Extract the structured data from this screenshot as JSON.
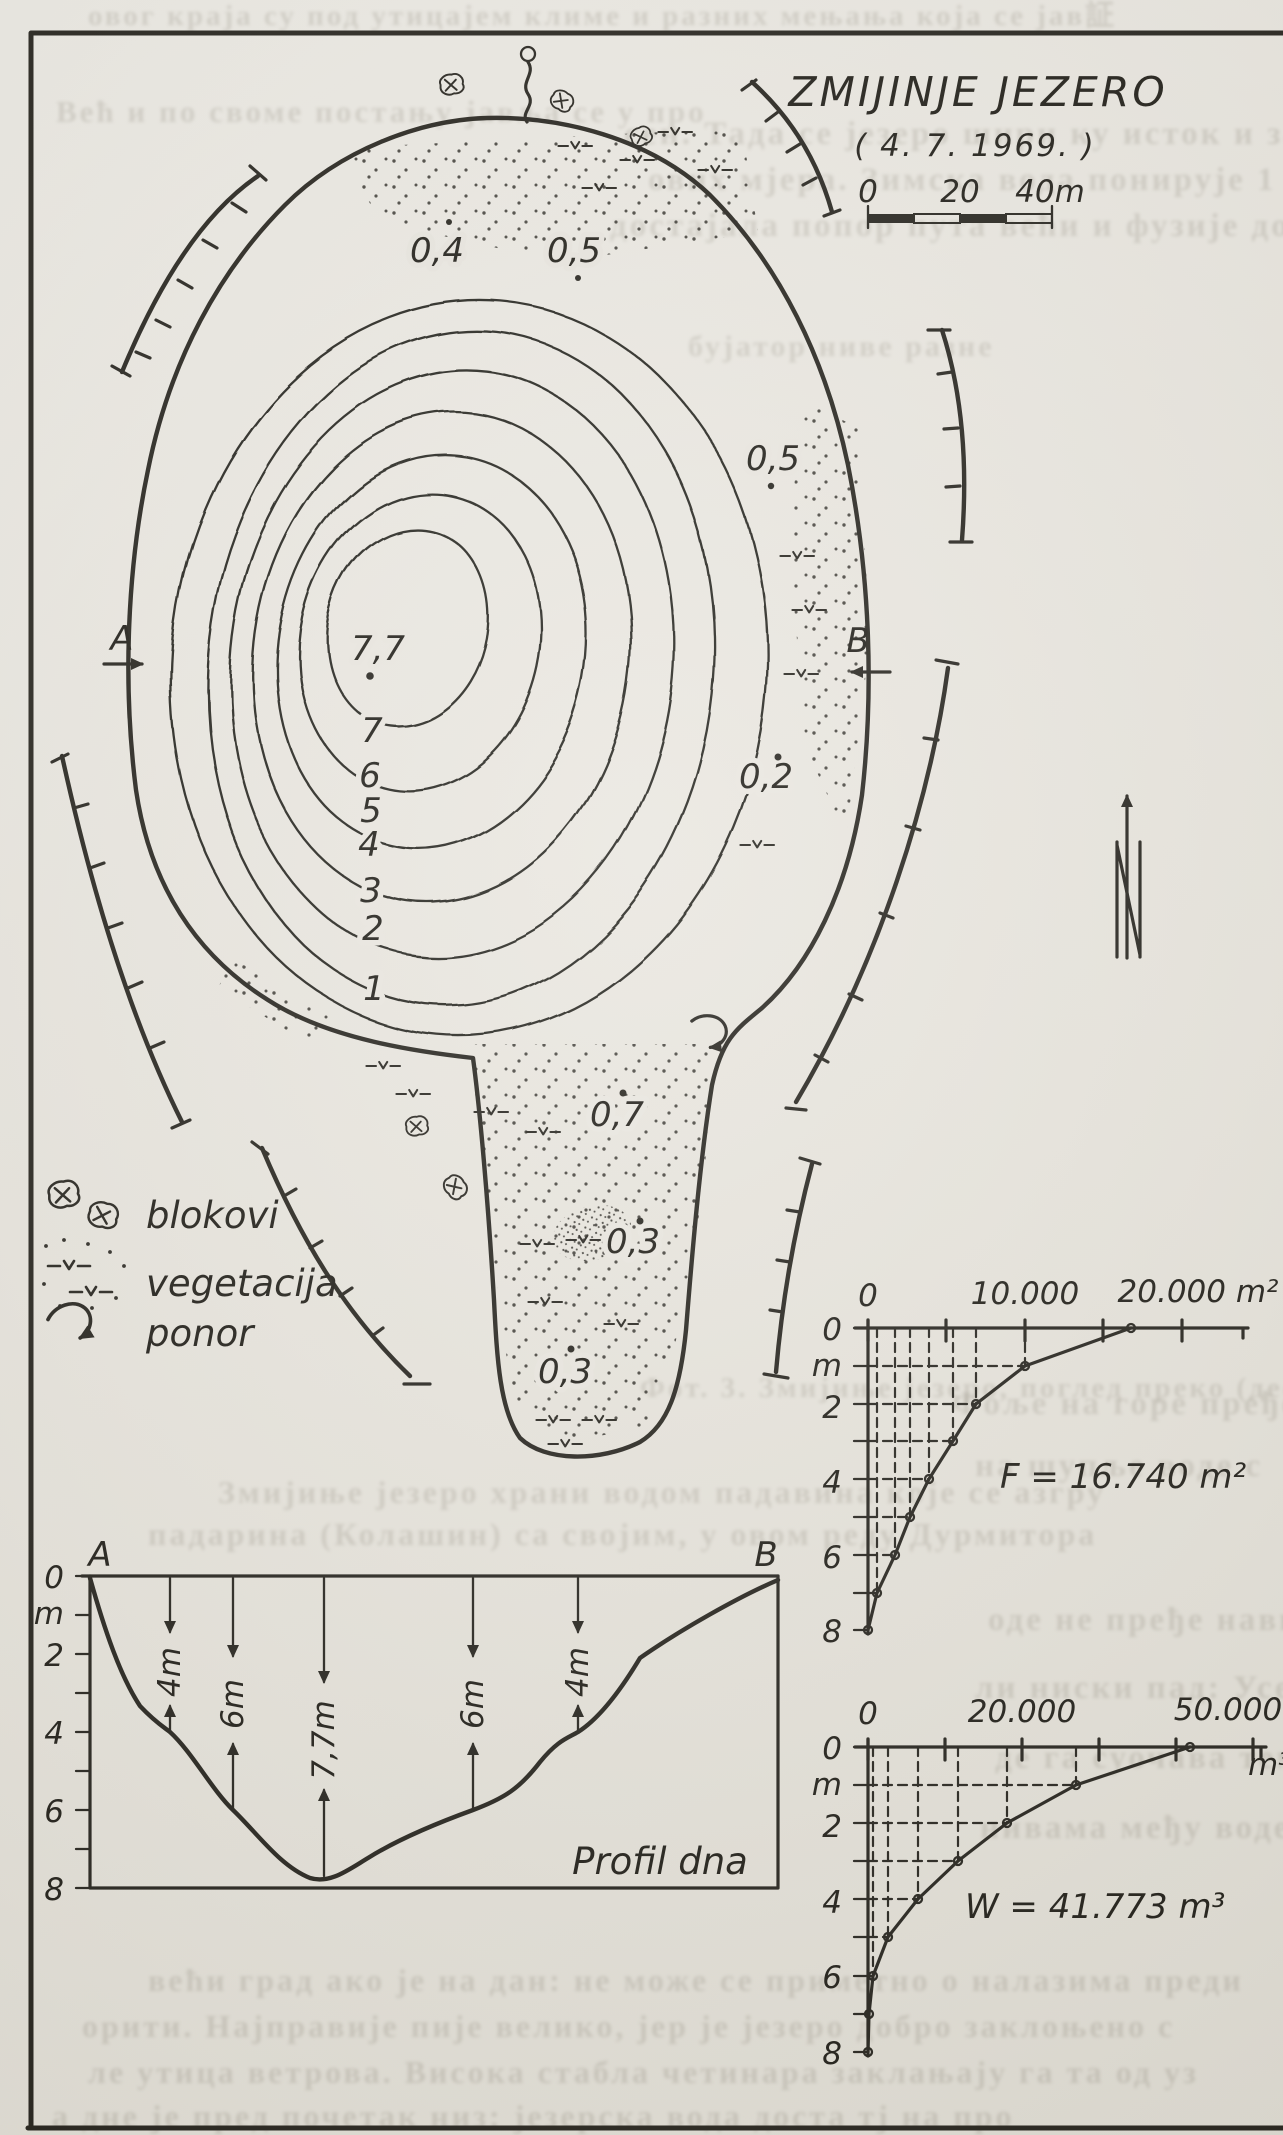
{
  "figure": {
    "title": "ZMIJINJE JEZERO",
    "date": "( 4. 7. 1969. )"
  },
  "scalebar": {
    "ticks": [
      "0",
      "20",
      "40m"
    ]
  },
  "sections": {
    "a": "A",
    "b": "B"
  },
  "map": {
    "spot_depths": {
      "s04": "0,4",
      "s05a": "0,5",
      "s05b": "0,5",
      "s02": "0,2",
      "s07": "0,7",
      "s03a": "0,3",
      "s03b": "0,3",
      "deep": "7,7"
    },
    "contour_labels": [
      "7",
      "6",
      "5",
      "4",
      "3",
      "2",
      "1"
    ]
  },
  "legend": {
    "items": [
      {
        "label": "blokovi"
      },
      {
        "label": "vegetacija"
      },
      {
        "label": "ponor"
      }
    ]
  },
  "area_graph": {
    "x_ticks": [
      "0",
      "10.000",
      "20.000 m²"
    ],
    "y_ticks": [
      "0",
      "m",
      "2",
      "4",
      "6",
      "8"
    ],
    "annotation": "F = 16.740 m²"
  },
  "volume_graph": {
    "x_ticks": [
      "0",
      "20.000",
      "50.000"
    ],
    "unit": "m³",
    "y_ticks": [
      "0",
      "m",
      "2",
      "4",
      "6",
      "8"
    ],
    "annotation": "W = 41.773 m³"
  },
  "profile": {
    "a": "A",
    "b": "B",
    "y_ticks": [
      "0",
      "m",
      "2",
      "4",
      "6",
      "8"
    ],
    "depth_arrows": [
      "4m",
      "6m",
      "7,7m",
      "6m",
      "4m"
    ],
    "caption": "Profil dna"
  },
  "chart_data": [
    {
      "type": "heatmap",
      "subtype": "bathymetric-contour-map",
      "title": "ZMIJINJE JEZERO ( 4. 7. 1969. )",
      "contour_depths_m": [
        1,
        2,
        3,
        4,
        5,
        6,
        7
      ],
      "max_depth_m": 7.7,
      "spot_depths_m": [
        0.4,
        0.5,
        0.5,
        0.2,
        0.7,
        0.3,
        0.3
      ],
      "scale_bar_m": [
        0,
        20,
        40
      ],
      "legend": [
        "blokovi",
        "vegetacija",
        "ponor"
      ],
      "north_arrow": true
    },
    {
      "type": "line",
      "title": "F = 16.740 m²",
      "xlabel": "area m²",
      "ylabel": "depth m",
      "x": [
        16740,
        10000,
        6900,
        5400,
        3900,
        2700,
        1700,
        600,
        0
      ],
      "y": [
        0,
        1,
        2,
        3,
        4,
        5,
        6,
        7,
        8
      ],
      "xlim": [
        0,
        24000
      ],
      "ylim": [
        0,
        8
      ],
      "x_tick_labels": [
        "0",
        "10.000",
        "20.000 m²"
      ],
      "grid": "dashed drop-lines at data points"
    },
    {
      "type": "line",
      "title": "W = 41.773 m³",
      "xlabel": "volume m³",
      "ylabel": "depth m",
      "x": [
        41773,
        27000,
        18000,
        11700,
        6500,
        2600,
        700,
        150,
        0
      ],
      "y": [
        0,
        1,
        2,
        3,
        4,
        5,
        6,
        7,
        8
      ],
      "xlim": [
        0,
        51000
      ],
      "ylim": [
        0,
        8
      ],
      "x_tick_labels": [
        "0",
        "20.000",
        "50.000",
        "m³"
      ],
      "grid": "dashed drop-lines at data points"
    },
    {
      "type": "area",
      "title": "Profil dna",
      "x": [
        "A",
        "B"
      ],
      "ylabel": "depth m",
      "ylim": [
        0,
        8
      ],
      "annotated_depths_m": [
        4,
        6,
        7.7,
        6,
        4
      ]
    }
  ],
  "bleed": {
    "lines": [
      {
        "t": "овог краја су под утицајем климе и разних мењања која се јав証"
      },
      {
        "t": "Већ и по своме постању јавља се у про"
      },
      {
        "t": "сен. Тада се језеро шири ку исток и запад и дивни р"
      },
      {
        "t": "ових мјера. Зимска вода понирује 1 м. При вис"
      },
      {
        "t": "достајала попор пута већи и фузије долине ње"
      },
      {
        "t": "бујатор ниве разне"
      },
      {
        "t": "Фот. 3. Змијиње језеро, поглед преко (десно) трећи"
      },
      {
        "t": "Змијиње језеро храни водом падавина које се азгру"
      },
      {
        "t": "падарина (Колашин) са својим, у овом реду Дурмитора"
      },
      {
        "t": "Фоље на горе пређе"
      },
      {
        "t": "на шупље воде с"
      },
      {
        "t": "оде не пређе навикне у пре"
      },
      {
        "t": "ли ниски пад: Усео воде, температура 4,7°С. Ме"
      },
      {
        "t": "де га суочава температура, ниво је поређено воде и"
      },
      {
        "t": "нивама међу воде и интен"
      },
      {
        "t": "већи град ако је на дан: не може се приметно о налазима преди"
      },
      {
        "t": "орити. Најправије пије велико, јер је језеро добро заклоњено с"
      },
      {
        "t": "ле утица ветрова. Висока стабла четинара заклањају га та од уз"
      },
      {
        "t": "а дне је пред почетак низ: језерска вода доста тј на про"
      }
    ]
  }
}
